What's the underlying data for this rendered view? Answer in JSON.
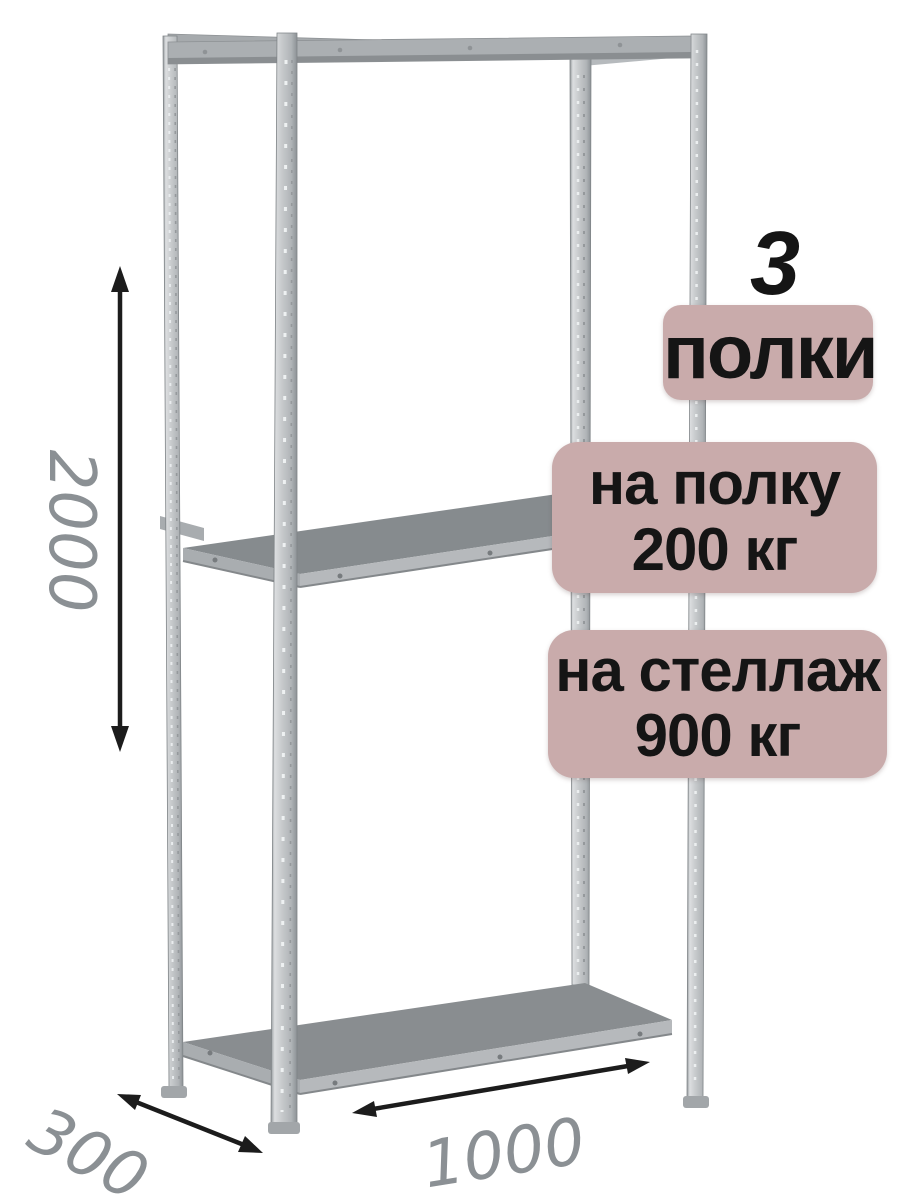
{
  "annotations": {
    "shelf_count": {
      "value": "3",
      "label": "полки"
    },
    "shelf_load": {
      "line1": "на полку",
      "line2": "200 кг"
    },
    "rack_load": {
      "line1": "на стеллаж",
      "line2": "900 кг"
    }
  },
  "dimensions": {
    "height_mm": "2000",
    "depth_mm": "300",
    "width_mm": "1000"
  },
  "colors": {
    "background": "#ffffff",
    "badge_background": "#c9abab",
    "badge_text": "#151515",
    "dimension_label": "#8b9094",
    "dimension_arrow": "#1c1c1c",
    "metal_light": "#d8dadc",
    "metal_mid": "#aeb2b5",
    "metal_dark": "#84888b",
    "shelf_surface": "#868b8e"
  }
}
